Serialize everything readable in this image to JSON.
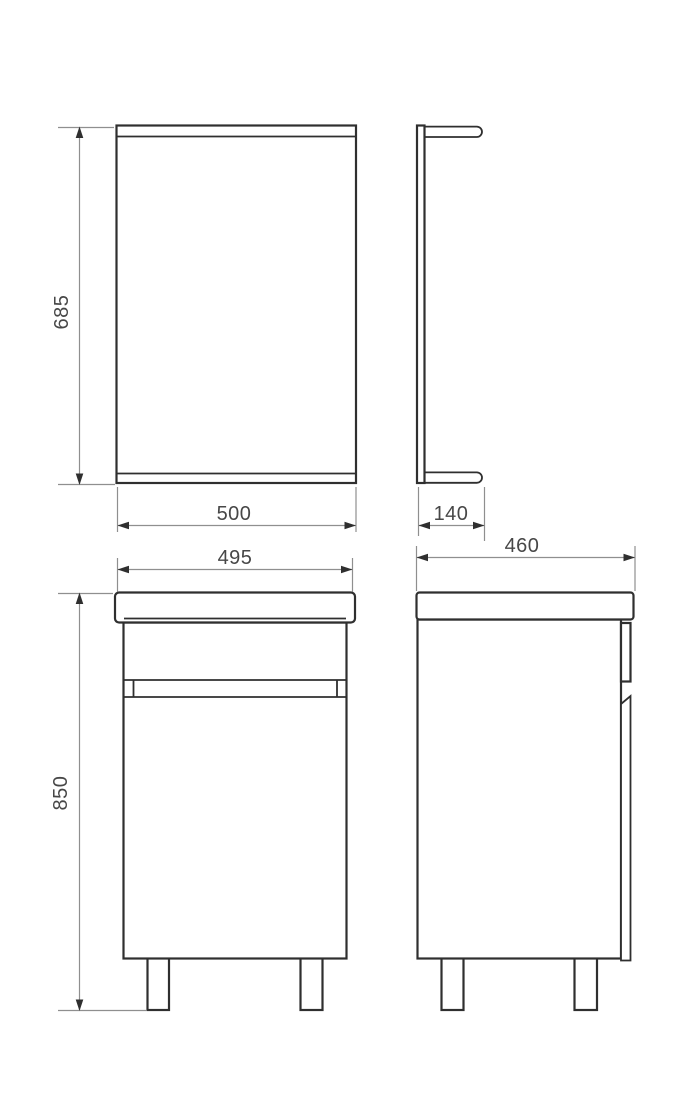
{
  "drawing": {
    "kind": "bathroom-furniture-technical-drawing",
    "dimension_labels": {
      "mirror_height": "685",
      "mirror_width": "500",
      "mirror_depth": "140",
      "vanity_width": "495",
      "vanity_depth": "460",
      "vanity_height": "850"
    },
    "colors": {
      "object_line": "#2f2f2f",
      "dimension_line": "#8f8f8f",
      "label_text": "#474747",
      "background": "#ffffff"
    }
  }
}
